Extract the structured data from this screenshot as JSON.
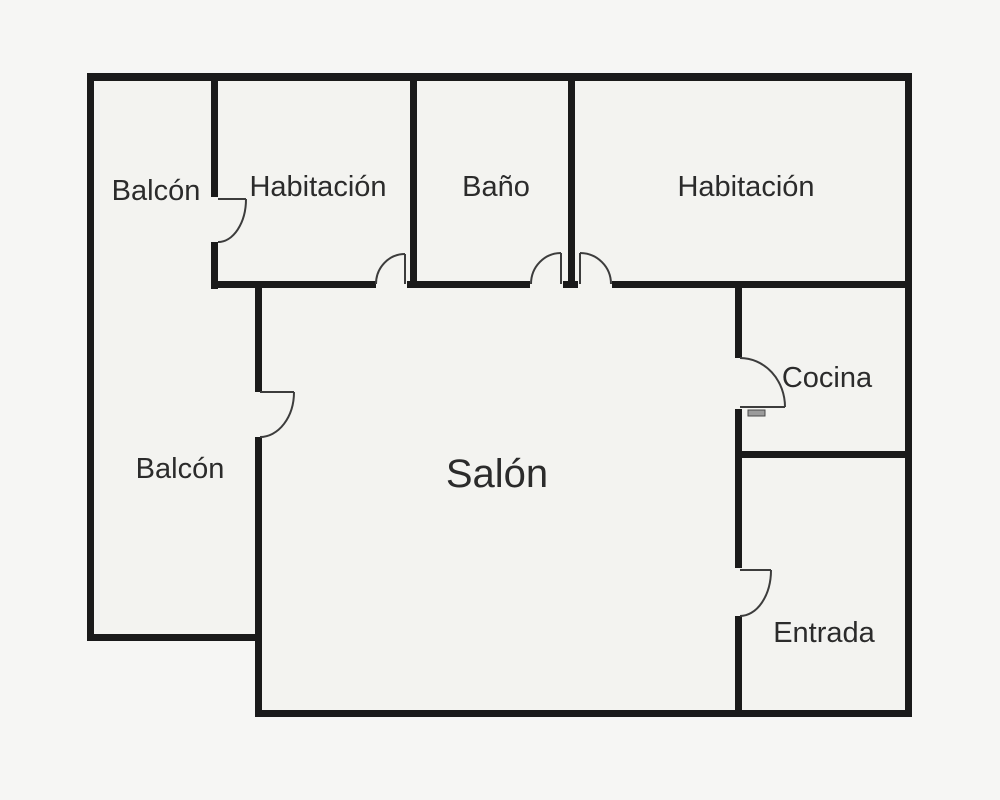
{
  "figure": {
    "type": "floor-plan",
    "language": "es"
  },
  "colors": {
    "background": "#f6f6f4",
    "floor": "#f3f3f0",
    "wall": "#1a1a1a",
    "door_arc": "#3c3c3c",
    "label_text": "#2b2b2b"
  },
  "rooms": [
    {
      "id": "balcon-top",
      "label": "Balcón"
    },
    {
      "id": "habitacion-left",
      "label": "Habitación"
    },
    {
      "id": "bano",
      "label": "Baño"
    },
    {
      "id": "habitacion-right",
      "label": "Habitación"
    },
    {
      "id": "cocina",
      "label": "Cocina"
    },
    {
      "id": "balcon-left",
      "label": "Balcón"
    },
    {
      "id": "salon",
      "label": "Salón"
    },
    {
      "id": "entrada",
      "label": "Entrada"
    }
  ],
  "doors": [
    {
      "id": "door-balcon-top-habitacion",
      "between": [
        "Balcón",
        "Habitación"
      ]
    },
    {
      "id": "door-habitacion-left-salon",
      "between": [
        "Habitación",
        "Salón"
      ]
    },
    {
      "id": "door-bano-salon",
      "between": [
        "Baño",
        "Salón"
      ]
    },
    {
      "id": "door-habitacion-right-salon",
      "between": [
        "Habitación",
        "Salón"
      ]
    },
    {
      "id": "door-balcon-left-salon",
      "between": [
        "Balcón",
        "Salón"
      ]
    },
    {
      "id": "door-salon-cocina",
      "between": [
        "Salón",
        "Cocina"
      ]
    },
    {
      "id": "door-salon-entrada",
      "between": [
        "Salón",
        "Entrada"
      ]
    }
  ]
}
